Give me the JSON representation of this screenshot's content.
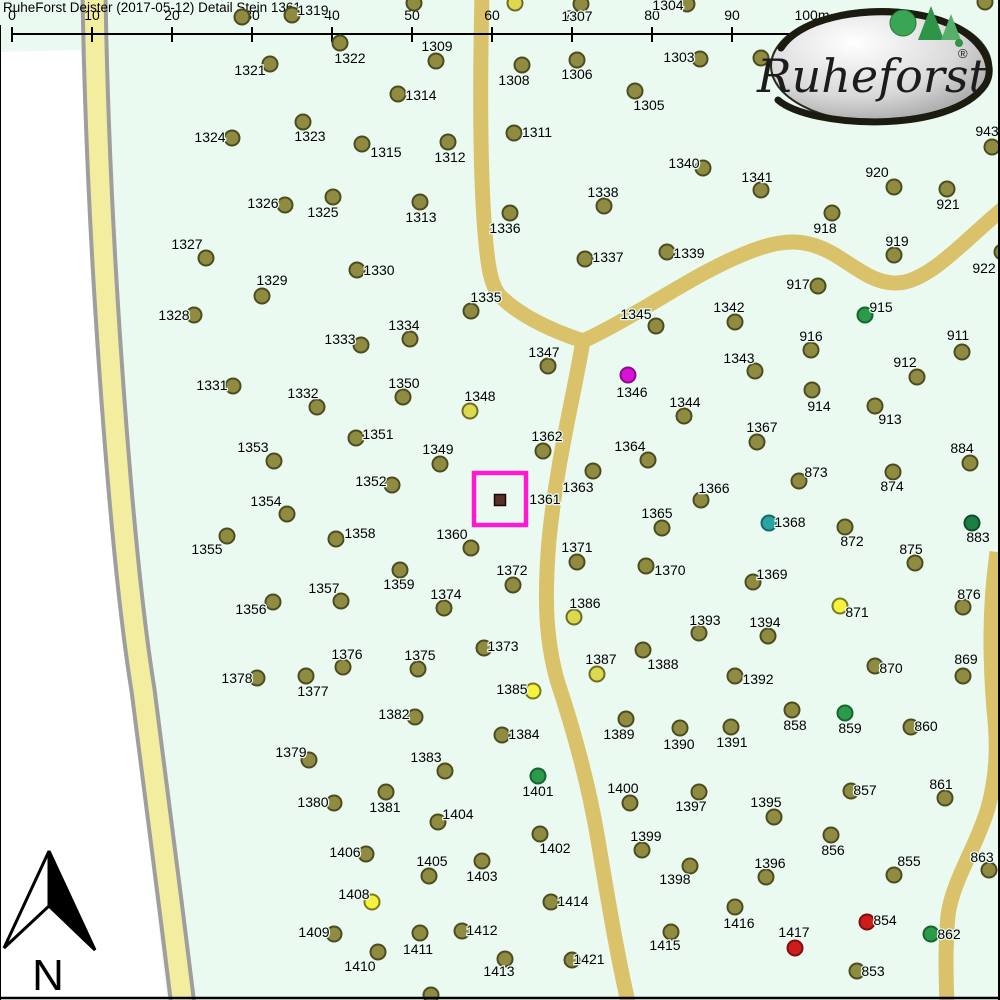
{
  "header": {
    "title": "RuheForst Deister (2017-05-12) Detail  Stein 1361"
  },
  "scale_bar": {
    "labels": [
      "0",
      "10",
      "20",
      "30",
      "40",
      "50",
      "60",
      "70",
      "80",
      "90",
      "100m"
    ],
    "x0": 12,
    "spacing": 80,
    "line_y": 34,
    "tick_top": 27,
    "tick_bottom": 42,
    "label_y": 20
  },
  "logo": {
    "text": "Ruheforst",
    "registered": "®"
  },
  "north_arrow": {
    "label": "N"
  },
  "highlight": {
    "label": "1361",
    "marker": {
      "x": 500,
      "y": 500
    },
    "box": {
      "x": 474,
      "y": 473,
      "w": 52,
      "h": 52
    },
    "label_x": 545,
    "label_y": 499
  },
  "colors": {
    "map_green": "#eafaf0",
    "outside_white": "#ffffff",
    "road_plain": "#d9c26a",
    "road_pale": "#f3eda0",
    "road_border": "#9e9e9e",
    "border_line": "#000000",
    "highlight_magenta": "#ff1ad1",
    "marker_brown": "#5c2f25",
    "dot": {
      "o": {
        "fill": "#8f8c42",
        "stroke": "#4c4c20"
      },
      "y": {
        "fill": "#f6f23b",
        "stroke": "#7a7a1e"
      },
      "dy": {
        "fill": "#dcd94e",
        "stroke": "#6e6c26"
      },
      "g": {
        "fill": "#2b9a4a",
        "stroke": "#14662e"
      },
      "dg": {
        "fill": "#1d7d45",
        "stroke": "#0d4f2a"
      },
      "t": {
        "fill": "#2ba3a3",
        "stroke": "#136a6a"
      },
      "m": {
        "fill": "#d911d9",
        "stroke": "#8a0a8a"
      },
      "r": {
        "fill": "#cf1b1b",
        "stroke": "#7c0f0f"
      }
    }
  },
  "roads": [
    {
      "name": "left-road",
      "type": "bordered",
      "d": "M94,-6 C96,120 103,260 111,373 C120,500 130,610 143,690 C156,790 170,900 183,1006"
    },
    {
      "name": "north-road",
      "type": "plain",
      "d": "M482,-6 C480,80 480,160 484,220 C487,262 490,285 500,296 C520,316 550,330 583,341"
    },
    {
      "name": "east-road",
      "type": "plain",
      "d": "M583,341 C640,315 700,268 760,248 C790,238 812,240 840,258 C862,272 880,287 905,282 C935,275 965,240 1006,206"
    },
    {
      "name": "south-road",
      "type": "plain",
      "d": "M583,341 C573,400 557,460 549,540 C544,600 546,640 557,680 C572,725 588,780 598,840 C608,900 618,960 629,1006"
    },
    {
      "name": "right-road",
      "type": "plain",
      "d": "M997,552 C989,610 990,660 994,710 C998,745 997,775 988,808 C975,850 953,880 948,915 C945,950 946,975 947,1006"
    }
  ],
  "outside_polygon": "M0,52 L81,50 C86,150 95,270 100,373 C106,480 115,560 124,600 C132,660 138,740 145,800 C152,870 160,940 167,1000 L0,1000 Z",
  "trees": [
    [
      "1319",
      292,
      15,
      313,
      10,
      "o"
    ],
    [
      "",
      242,
      17,
      0,
      0,
      "o"
    ],
    [
      "",
      414,
      3,
      0,
      0,
      "o"
    ],
    [
      "",
      515,
      3,
      0,
      0,
      "dy"
    ],
    [
      "1307",
      581,
      4,
      577,
      16,
      "o"
    ],
    [
      "1304",
      687,
      4,
      668,
      5,
      "o"
    ],
    [
      "1309",
      436,
      61,
      437,
      46,
      "o"
    ],
    [
      "1322",
      340,
      43,
      350,
      58,
      "o"
    ],
    [
      "1303",
      700,
      59,
      679,
      57,
      "o"
    ],
    [
      "1306",
      577,
      60,
      577,
      74,
      "o"
    ],
    [
      "1308",
      522,
      65,
      514,
      80,
      "o"
    ],
    [
      "1305",
      635,
      91,
      649,
      105,
      "o"
    ],
    [
      "",
      761,
      58,
      0,
      0,
      "o"
    ],
    [
      "943",
      992,
      147,
      987,
      131,
      "o"
    ],
    [
      "",
      985,
      2,
      0,
      0,
      "o"
    ],
    [
      "1321",
      270,
      64,
      250,
      70,
      "o"
    ],
    [
      "1314",
      398,
      94,
      421,
      95,
      "o"
    ],
    [
      "1323",
      303,
      122,
      310,
      136,
      "o"
    ],
    [
      "1324",
      232,
      138,
      210,
      137,
      "o"
    ],
    [
      "1315",
      362,
      144,
      386,
      152,
      "o"
    ],
    [
      "1312",
      448,
      142,
      450,
      157,
      "o"
    ],
    [
      "1311",
      514,
      133,
      537,
      132,
      "o"
    ],
    [
      "1326",
      285,
      205,
      263,
      203,
      "o"
    ],
    [
      "1325",
      333,
      197,
      323,
      212,
      "o"
    ],
    [
      "1313",
      420,
      202,
      421,
      217,
      "o"
    ],
    [
      "1336",
      510,
      213,
      505,
      228,
      "o"
    ],
    [
      "1338",
      604,
      206,
      603,
      192,
      "o"
    ],
    [
      "1340",
      703,
      168,
      684,
      163,
      "o"
    ],
    [
      "1341",
      761,
      190,
      757,
      177,
      "o"
    ],
    [
      "920",
      894,
      187,
      877,
      172,
      "o"
    ],
    [
      "921",
      947,
      189,
      948,
      204,
      "o"
    ],
    [
      "918",
      832,
      213,
      825,
      228,
      "o"
    ],
    [
      "919",
      894,
      255,
      897,
      241,
      "o"
    ],
    [
      "917",
      818,
      286,
      798,
      284,
      "o"
    ],
    [
      "915",
      865,
      315,
      881,
      307,
      "g"
    ],
    [
      "922",
      1002,
      252,
      984,
      268,
      "o"
    ],
    [
      "916",
      811,
      350,
      811,
      336,
      "o"
    ],
    [
      "911",
      962,
      352,
      958,
      335,
      "o"
    ],
    [
      "912",
      917,
      377,
      905,
      362,
      "o"
    ],
    [
      "913",
      875,
      406,
      890,
      419,
      "o"
    ],
    [
      "914",
      812,
      390,
      819,
      406,
      "o"
    ],
    [
      "1327",
      206,
      258,
      187,
      244,
      "o"
    ],
    [
      "1329",
      262,
      296,
      272,
      280,
      "o"
    ],
    [
      "1328",
      194,
      315,
      174,
      315,
      "o"
    ],
    [
      "1330",
      357,
      270,
      379,
      270,
      "o"
    ],
    [
      "1333",
      361,
      345,
      340,
      339,
      "o"
    ],
    [
      "1334",
      410,
      339,
      404,
      325,
      "o"
    ],
    [
      "1335",
      471,
      311,
      486,
      297,
      "o"
    ],
    [
      "1337",
      585,
      259,
      608,
      257,
      "o"
    ],
    [
      "1339",
      667,
      252,
      689,
      253,
      "o"
    ],
    [
      "1342",
      735,
      322,
      729,
      307,
      "o"
    ],
    [
      "1345",
      656,
      326,
      636,
      314,
      "o"
    ],
    [
      "1343",
      755,
      371,
      739,
      358,
      "o"
    ],
    [
      "1347",
      548,
      366,
      544,
      352,
      "o"
    ],
    [
      "1346",
      628,
      375,
      632,
      392,
      "m"
    ],
    [
      "1344",
      684,
      416,
      685,
      402,
      "o"
    ],
    [
      "1331",
      233,
      386,
      212,
      385,
      "o"
    ],
    [
      "1332",
      317,
      407,
      303,
      393,
      "o"
    ],
    [
      "1350",
      403,
      397,
      404,
      383,
      "o"
    ],
    [
      "1348",
      470,
      411,
      480,
      396,
      "dy"
    ],
    [
      "1362",
      543,
      451,
      547,
      436,
      "o"
    ],
    [
      "1364",
      648,
      460,
      630,
      446,
      "o"
    ],
    [
      "1367",
      757,
      442,
      762,
      427,
      "o"
    ],
    [
      "873",
      799,
      481,
      816,
      472,
      "o"
    ],
    [
      "874",
      893,
      472,
      892,
      486,
      "o"
    ],
    [
      "884",
      970,
      463,
      962,
      448,
      "o"
    ],
    [
      "1351",
      356,
      438,
      378,
      434,
      "o"
    ],
    [
      "1349",
      440,
      464,
      438,
      449,
      "o"
    ],
    [
      "1352",
      392,
      485,
      371,
      481,
      "o"
    ],
    [
      "1363",
      593,
      471,
      578,
      487,
      "o"
    ],
    [
      "1366",
      701,
      500,
      714,
      488,
      "o"
    ],
    [
      "1365",
      662,
      528,
      657,
      513,
      "o"
    ],
    [
      "1368",
      769,
      523,
      790,
      522,
      "t"
    ],
    [
      "872",
      845,
      527,
      852,
      541,
      "o"
    ],
    [
      "883",
      972,
      523,
      978,
      537,
      "dg"
    ],
    [
      "875",
      915,
      563,
      911,
      549,
      "o"
    ],
    [
      "1353",
      274,
      461,
      253,
      447,
      "o"
    ],
    [
      "1354",
      287,
      514,
      266,
      501,
      "o"
    ],
    [
      "1355",
      227,
      536,
      207,
      549,
      "o"
    ],
    [
      "1358",
      336,
      539,
      360,
      533,
      "o"
    ],
    [
      "1360",
      471,
      548,
      452,
      534,
      "o"
    ],
    [
      "1371",
      577,
      562,
      577,
      547,
      "o"
    ],
    [
      "1359",
      400,
      570,
      399,
      584,
      "o"
    ],
    [
      "1372",
      513,
      585,
      512,
      570,
      "o"
    ],
    [
      "1370",
      646,
      566,
      670,
      570,
      "o"
    ],
    [
      "1369",
      753,
      582,
      772,
      574,
      "o"
    ],
    [
      "871",
      840,
      606,
      857,
      612,
      "y"
    ],
    [
      "876",
      963,
      607,
      969,
      594,
      "o"
    ],
    [
      "1357",
      341,
      601,
      324,
      588,
      "o"
    ],
    [
      "1356",
      273,
      602,
      251,
      609,
      "o"
    ],
    [
      "1386",
      574,
      617,
      585,
      603,
      "dy"
    ],
    [
      "1373",
      484,
      648,
      503,
      646,
      "o"
    ],
    [
      "1374",
      444,
      608,
      446,
      594,
      "o"
    ],
    [
      "1376",
      343,
      667,
      347,
      654,
      "o"
    ],
    [
      "1375",
      418,
      669,
      420,
      655,
      "o"
    ],
    [
      "1387",
      597,
      674,
      601,
      659,
      "dy"
    ],
    [
      "1388",
      643,
      650,
      663,
      664,
      "o"
    ],
    [
      "1393",
      699,
      633,
      705,
      620,
      "o"
    ],
    [
      "1394",
      768,
      636,
      765,
      622,
      "o"
    ],
    [
      "870",
      875,
      666,
      891,
      668,
      "o"
    ],
    [
      "869",
      963,
      676,
      966,
      659,
      "o"
    ],
    [
      "1392",
      735,
      676,
      758,
      679,
      "o"
    ],
    [
      "1377",
      306,
      676,
      313,
      691,
      "o"
    ],
    [
      "1378",
      257,
      678,
      237,
      678,
      "o"
    ],
    [
      "1379",
      309,
      760,
      291,
      752,
      "o"
    ],
    [
      "1382",
      415,
      717,
      394,
      714,
      "o"
    ],
    [
      "1385",
      533,
      691,
      512,
      689,
      "y"
    ],
    [
      "1384",
      502,
      735,
      524,
      734,
      "o"
    ],
    [
      "1383",
      445,
      771,
      426,
      757,
      "o"
    ],
    [
      "1401",
      538,
      776,
      538,
      791,
      "g"
    ],
    [
      "1389",
      626,
      719,
      619,
      734,
      "o"
    ],
    [
      "1390",
      680,
      728,
      679,
      744,
      "o"
    ],
    [
      "1391",
      731,
      727,
      732,
      742,
      "o"
    ],
    [
      "858",
      792,
      710,
      795,
      725,
      "o"
    ],
    [
      "859",
      845,
      713,
      850,
      728,
      "g"
    ],
    [
      "860",
      911,
      727,
      926,
      726,
      "o"
    ],
    [
      "861",
      945,
      798,
      941,
      784,
      "o"
    ],
    [
      "857",
      851,
      791,
      865,
      790,
      "o"
    ],
    [
      "1380",
      334,
      803,
      313,
      802,
      "o"
    ],
    [
      "1381",
      386,
      792,
      385,
      807,
      "o"
    ],
    [
      "1400",
      630,
      803,
      623,
      788,
      "o"
    ],
    [
      "1397",
      699,
      792,
      691,
      806,
      "o"
    ],
    [
      "1395",
      774,
      817,
      766,
      802,
      "o"
    ],
    [
      "1404",
      438,
      822,
      458,
      814,
      "o"
    ],
    [
      "1402",
      540,
      834,
      555,
      848,
      "o"
    ],
    [
      "1406",
      366,
      854,
      345,
      852,
      "o"
    ],
    [
      "1405",
      429,
      876,
      432,
      861,
      "o"
    ],
    [
      "1403",
      482,
      861,
      482,
      876,
      "o"
    ],
    [
      "1399",
      642,
      850,
      646,
      836,
      "o"
    ],
    [
      "856",
      831,
      835,
      833,
      850,
      "o"
    ],
    [
      "1398",
      690,
      866,
      675,
      879,
      "o"
    ],
    [
      "1396",
      766,
      877,
      770,
      863,
      "o"
    ],
    [
      "855",
      894,
      875,
      909,
      861,
      "o"
    ],
    [
      "863",
      989,
      870,
      982,
      857,
      "o"
    ],
    [
      "1408",
      372,
      902,
      354,
      894,
      "y"
    ],
    [
      "1414",
      551,
      902,
      573,
      901,
      "o"
    ],
    [
      "1416",
      735,
      907,
      739,
      923,
      "o"
    ],
    [
      "854",
      867,
      922,
      885,
      920,
      "r"
    ],
    [
      "862",
      931,
      934,
      949,
      934,
      "g"
    ],
    [
      "1409",
      334,
      934,
      314,
      932,
      "o"
    ],
    [
      "1412",
      462,
      931,
      482,
      930,
      "o"
    ],
    [
      "1411",
      420,
      933,
      418,
      949,
      "o"
    ],
    [
      "1415",
      671,
      932,
      665,
      945,
      "o"
    ],
    [
      "1417",
      795,
      948,
      794,
      932,
      "r"
    ],
    [
      "1410",
      378,
      952,
      360,
      966,
      "o"
    ],
    [
      "1413",
      505,
      959,
      499,
      971,
      "o"
    ],
    [
      "1421",
      572,
      960,
      589,
      959,
      "o"
    ],
    [
      "853",
      857,
      971,
      873,
      971,
      "o"
    ],
    [
      "",
      431,
      995,
      0,
      0,
      "o"
    ]
  ]
}
